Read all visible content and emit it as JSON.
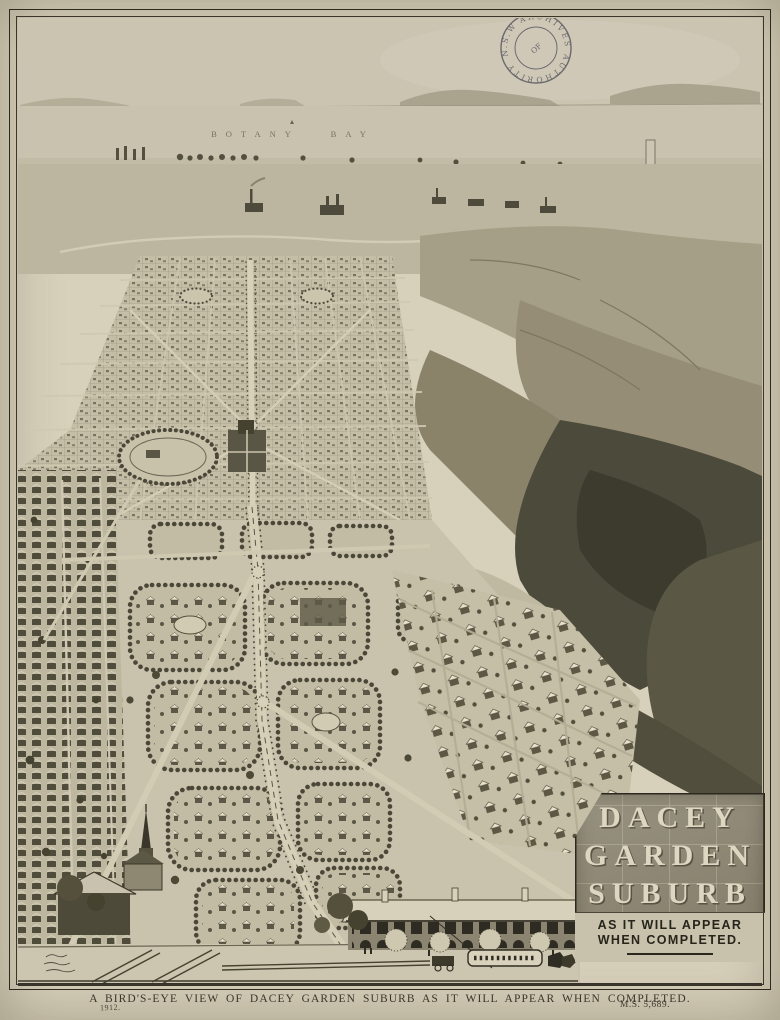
{
  "map": {
    "bay_label": "BOTANY BAY",
    "stamp": {
      "text_main": "ARCHIVES AUTHORITY",
      "text_region": "N.S.W.",
      "text_center": "OF"
    },
    "title_box": {
      "lines": [
        "DACEY",
        "GARDEN",
        "SUBURB"
      ],
      "subtitle_line1": "AS IT WILL APPEAR",
      "subtitle_line2": "WHEN COMPLETED."
    }
  },
  "footer": {
    "caption": "A BIRD'S-EYE VIEW OF DACEY GARDEN SUBURB AS IT WILL APPEAR WHEN COMPLETED.",
    "year": "1912.",
    "reference": "M.S. 5,689."
  },
  "colors": {
    "paper": "#d7d0bb",
    "ink": "#2e2b21",
    "stamp_ink": "#50505a",
    "title_box_background": "#8b8572",
    "title_letters": "#ddd6c0",
    "dark_forest": "#4c4a3a"
  }
}
